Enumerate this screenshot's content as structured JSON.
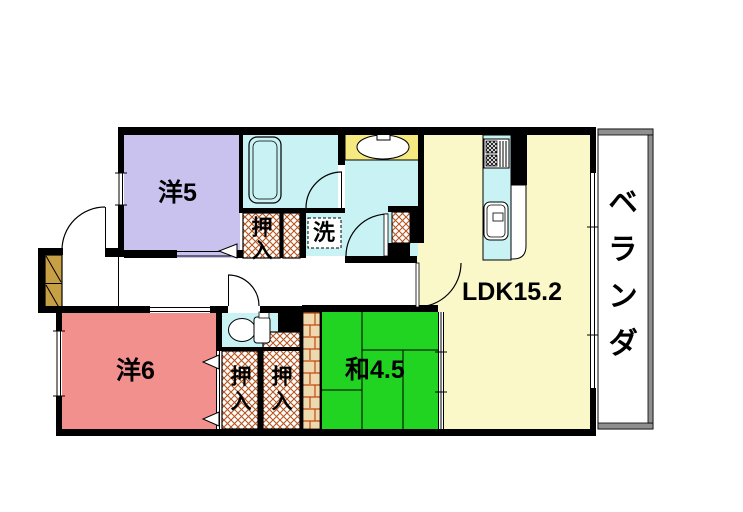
{
  "title": "apartment-floorplan",
  "colors": {
    "room-western5": "#c9c1ee",
    "room-western6": "#f2908e",
    "room-japanese": "#22d422",
    "room-ldk": "#faf7c8",
    "counter-yellow": "#f6e97f",
    "water-cyan": "#c8f2f4",
    "cabinet-brown": "#c79f45",
    "hatch-line": "#b5541f",
    "brick-bg": "#eed9ae",
    "brick-line": "#c04a10",
    "veranda-gray": "#8f8f8f",
    "wall": "#000000"
  },
  "rooms": {
    "western5": {
      "label": "洋5"
    },
    "western6": {
      "label": "洋6"
    },
    "japanese45": {
      "label": "和4.5"
    },
    "ldk": {
      "label": "LDK15.2"
    },
    "veranda": {
      "label": "ベランダ"
    }
  },
  "closets": {
    "upper": {
      "label": "押入"
    },
    "lower_left": {
      "label": "押入"
    },
    "lower_right": {
      "label": "押入"
    }
  },
  "fixtures": {
    "laundry_label": "洗",
    "icons": [
      "bathtub-icon",
      "washbasin-icon",
      "toilet-icon",
      "stove-icon",
      "kitchen-sink-icon",
      "shoe-cabinet-icon"
    ]
  }
}
